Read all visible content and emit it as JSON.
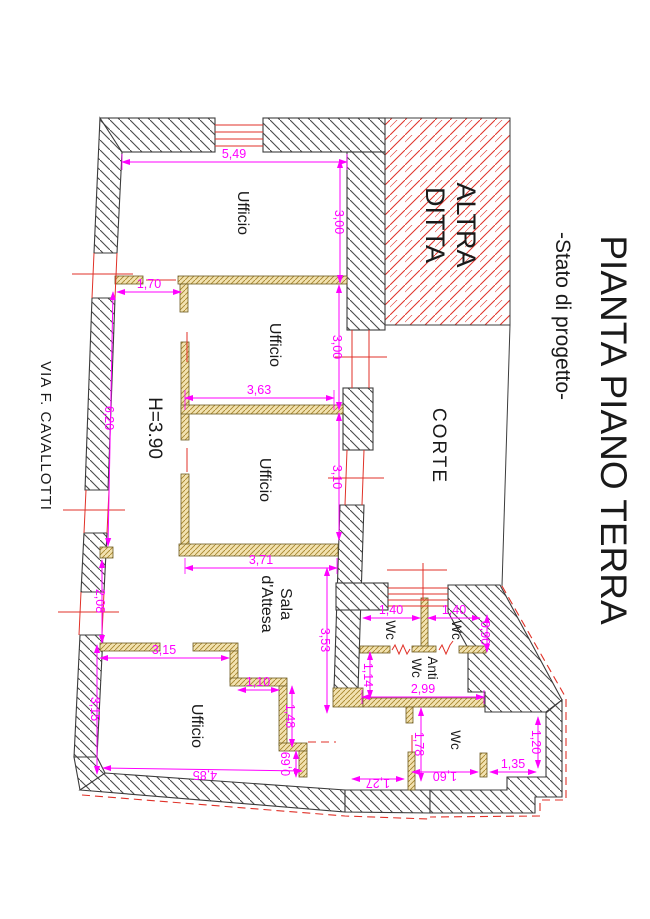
{
  "header": {
    "title": "PIANTA PIANO TERRA",
    "subtitle": "-Stato di progetto-"
  },
  "street_label": "VIA F. CAVALLOTTI",
  "zones": {
    "other_company": {
      "line1": "ALTRA",
      "line2": "DITTA"
    },
    "courtyard": "CORTE"
  },
  "rooms": {
    "office1": "Ufficio",
    "office2": "Ufficio",
    "office3": "Ufficio",
    "office4": "Ufficio",
    "waiting_room": {
      "line1": "Sala",
      "line2": "d'Attesa"
    },
    "wc_left": "Wc",
    "wc_right": "Wc",
    "wc_large": "Wc",
    "anti_wc": {
      "line1": "Anti",
      "line2": "Wc"
    },
    "ceiling_height": "H=3.90"
  },
  "dimensions": {
    "top_width": "5,49",
    "office1_depth": "3,00",
    "door_offset": "1,70",
    "left_side": "6,20",
    "office2_width": "3,63",
    "office2_depth": "3,00",
    "office3_depth": "3,10",
    "office3_width": "3,71",
    "waiting_depth": "3,53",
    "corridor_left": "2,08",
    "office4_width_top": "3,15",
    "office4_left": "3,15",
    "step_width": "1,10",
    "step_depth": "1,48",
    "step_small": "0,69",
    "office4_bottom": "4,85",
    "wc_left_width": "1,40",
    "wc_right_width": "1,40",
    "wc_depth": "0,90",
    "antiwc_left": "1,14",
    "antiwc_width": "2,99",
    "wc_large_depth": "1,78",
    "wc_large_bottom": "1,60",
    "wc_large_bottom_left": "1,27",
    "wc_large_right": "1,20",
    "wc_large_bottom_right": "1,35"
  },
  "colors": {
    "dimension": "#FF00FF",
    "window": "#E03128",
    "wall_line": "#3C3C3C",
    "partition_fill": "#F2E2B0",
    "partition_line": "#A8862E",
    "other_company_hatch": "#E03128"
  }
}
